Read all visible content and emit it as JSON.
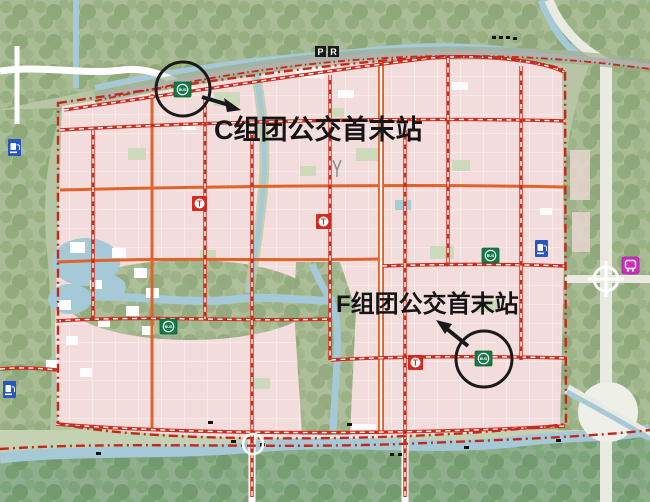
{
  "map": {
    "type": "urban-planning-transit-map",
    "annotations": {
      "c_terminal": {
        "label": "C组团公交首末站"
      },
      "f_terminal": {
        "label": "F组团公交首末站"
      }
    },
    "icons": {
      "bus_station_label": "BUS",
      "tram_station_label": "T",
      "park_and_ride_p_label": "P",
      "park_and_ride_r_label": "R"
    },
    "colors": {
      "urban_pink": "#f3dcdc",
      "road_orange": "#e2622a",
      "road_dashed_red": "#cb2c1b",
      "boundary_red": "#c4281a",
      "water_blue": "#a5c9d7",
      "bus_station_green": "#157a47",
      "tram_station_red": "#d6281e",
      "gas_station_blue": "#2456c4",
      "bus_depot_magenta": "#cb2fc0",
      "annotation_black": "#151515"
    }
  }
}
